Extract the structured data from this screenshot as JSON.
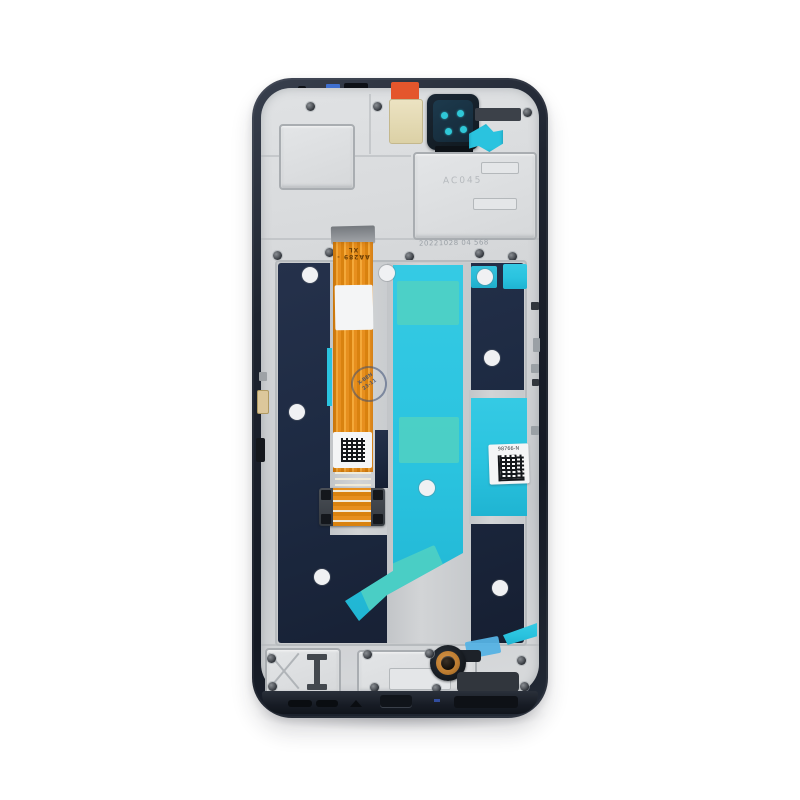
{
  "photo": {
    "subject": "Smartphone LCD display assembly with frame, rear view",
    "markings": {
      "date_stamp": "20221028 04 568",
      "flex_marking": "AA289 -XL",
      "plate_marking": "AC045",
      "right_label_code": "98766-N",
      "ink_stamp_line1": "X-BEN",
      "ink_stamp_line2": "23-11"
    }
  },
  "colors": {
    "background": "#ffffff",
    "frame_dark": "#1e2430",
    "metal_silver": "#d4d6d8",
    "panel_navy": "#1d2a42",
    "adhesive_cyan": "#2ac3df",
    "adhesive_teal_light": "#4fd0c3",
    "flex_orange": "#e78f1e",
    "tape_blue": "#55b2e4",
    "copper_ring": "#bc7c30",
    "camera_teal": "#2fc7d7",
    "label_white": "#f4f5f6",
    "stamp_gray": "#9aa0a6",
    "ink_navy": "#3c4e74"
  }
}
